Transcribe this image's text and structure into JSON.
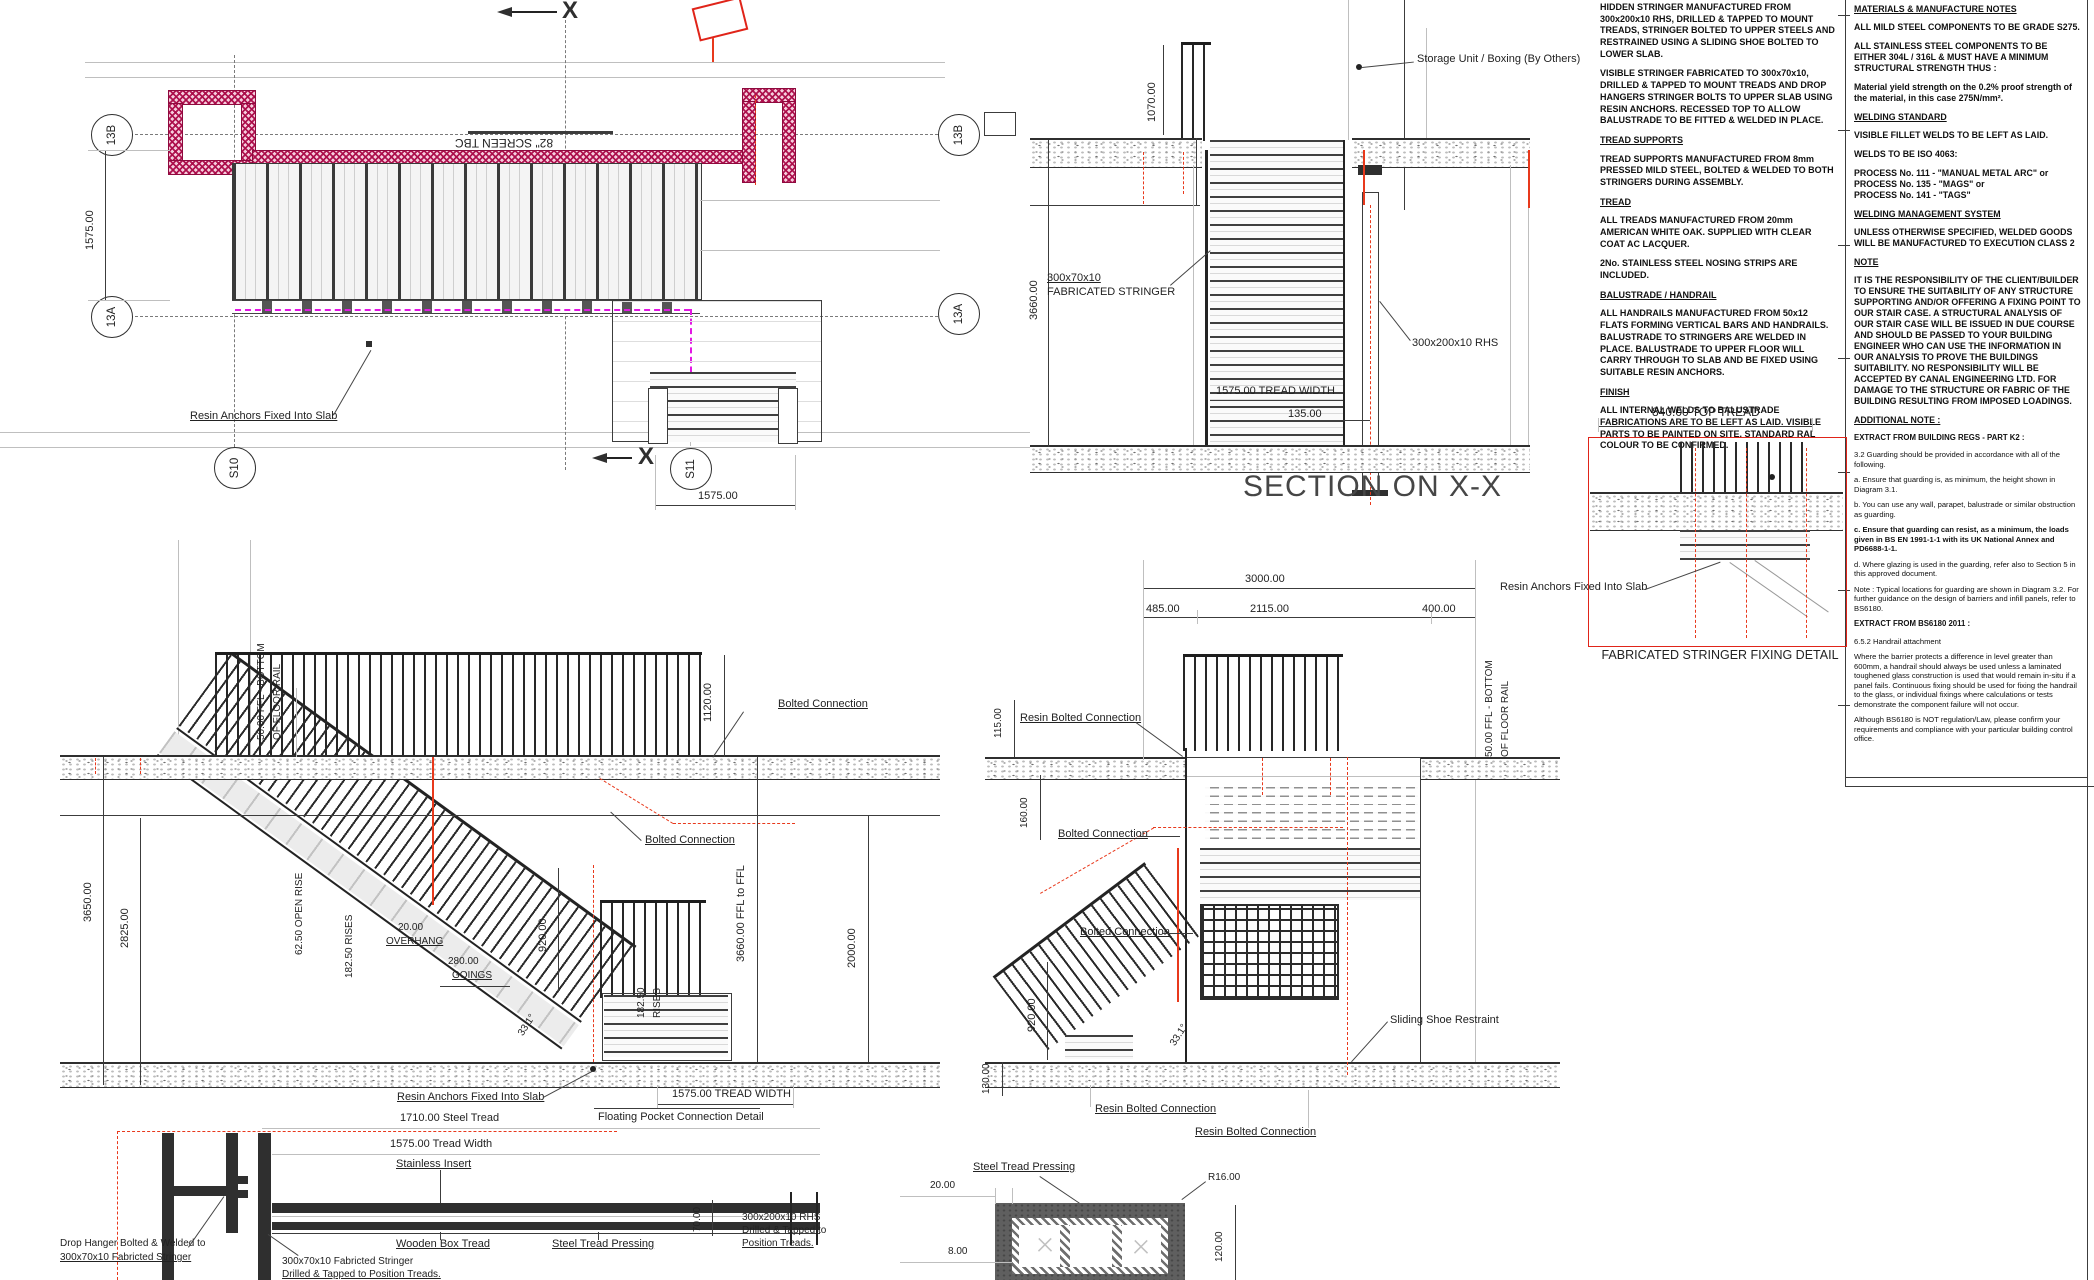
{
  "plan": {
    "screen_label": "82\" SCREEN TBC",
    "resin_anchors": "Resin Anchors Fixed Into Slab",
    "dim_width_v": "1575.00",
    "dim_width_h": "1575.00",
    "section_marker": "X",
    "bubbles": {
      "b13b": "13B",
      "b13a": "13A",
      "s10": "S10",
      "s11": "S11"
    }
  },
  "section_xx": {
    "title": "SECTION ON X-X",
    "storage_label": "Storage Unit / Boxing (By Others)",
    "dim_1070": "1070.00",
    "dim_3660": "3660.00",
    "stringer_label_1": "300x70x10",
    "stringer_label_2": "FABRICATED STRINGER",
    "rhs_label": "300x200x10 RHS",
    "dim_tread_width": "1575.00 TREAD WIDTH",
    "dim_135": "135.00"
  },
  "fabrication_notes": {
    "p_hidden": "HIDDEN STRINGER MANUFACTURED FROM 300x200x10 RHS, DRILLED & TAPPED TO MOUNT TREADS, STRINGER BOLTED TO UPPER STEELS AND RESTRAINED USING A SLIDING SHOE BOLTED TO LOWER SLAB.",
    "p_visible": "VISIBLE STRINGER FABRICATED TO 300x70x10, DRILLED & TAPPED TO MOUNT TREADS AND DROP HANGERS STRINGER BOLTS TO UPPER SLAB USING RESIN ANCHORS. RECESSED TOP TO ALLOW BALUSTRADE TO BE FITTED & WELDED IN PLACE.",
    "h_tread_supports": "TREAD SUPPORTS",
    "p_tread_supports": "TREAD SUPPORTS MANUFACTURED FROM 8mm PRESSED MILD STEEL, BOLTED & WELDED TO BOTH STRINGERS DURING ASSEMBLY.",
    "h_tread": "TREAD",
    "p_tread_1": "ALL TREADS MANUFACTURED FROM 20mm AMERICAN WHITE OAK. SUPPLIED WITH CLEAR COAT AC LACQUER.",
    "p_tread_2": "2No. STAINLESS STEEL NOSING STRIPS ARE INCLUDED.",
    "h_balustrade": "BALUSTRADE / HANDRAIL",
    "p_balustrade": "ALL HANDRAILS MANUFACTURED FROM 50x12 FLATS FORMING VERTICAL BARS AND HANDRAILS. BALUSTRADE TO STRINGERS ARE WELDED IN PLACE. BALUSTRADE TO UPPER FLOOR WILL CARRY THROUGH TO SLAB AND BE FIXED USING SUITABLE RESIN ANCHORS.",
    "h_finish": "FINISH",
    "p_finish": "ALL INTERNAL WELDS TO BALUSTRADE FABRICATIONS ARE TO BE LEFT AS LAID. VISIBLE PARTS TO BE PAINTED ON SITE. STANDARD RAL COLOUR TO BE CONFIRMED."
  },
  "fixing_detail": {
    "dim_840": "840.00 TOP TREAD",
    "resin_anchors": "Resin Anchors Fixed Into Slab",
    "title": "FABRICATED STRINGER FIXING DETAIL"
  },
  "materials_notes": {
    "h_main": "MATERIALS & MANUFACTURE NOTES",
    "p1": "ALL MILD STEEL COMPONENTS TO BE GRADE S275.",
    "p2": "ALL STAINLESS STEEL COMPONENTS TO BE EITHER 304L / 316L & MUST HAVE A MINIMUM STRUCTURAL STRENGTH THUS :",
    "p3": "Material yield strength on the 0.2% proof strength of the material, in this case 275N/mm².",
    "h_welding": "WELDING STANDARD",
    "p4": "VISIBLE FILLET WELDS TO BE LEFT AS LAID.",
    "p5": "WELDS TO BE ISO 4063:",
    "p6a": "PROCESS No. 111 - \"MANUAL METAL ARC\" or",
    "p6b": "PROCESS No. 135 - \"MAGS\" or",
    "p6c": "PROCESS No. 141 - \"TAGS\"",
    "h_wms": "WELDING MANAGEMENT SYSTEM",
    "p7": "UNLESS OTHERWISE SPECIFIED, WELDED GOODS WILL BE MANUFACTURED TO EXECUTION CLASS 2",
    "h_note": "NOTE",
    "p8": "IT IS THE RESPONSIBILITY OF THE CLIENT/BUILDER TO ENSURE THE SUITABILITY OF ANY STRUCTURE SUPPORTING AND/OR OFFERING A FIXING POINT TO OUR STAIR CASE. A STRUCTURAL ANALYSIS OF OUR STAIR CASE WILL BE ISSUED IN DUE COURSE AND SHOULD BE PASSED TO YOUR BUILDING ENGINEER WHO CAN USE THE INFORMATION IN OUR ANALYSIS TO PROVE THE BUILDINGS SUITABILITY. NO RESPONSIBILITY WILL BE ACCEPTED BY CANAL ENGINEERING LTD. FOR DAMAGE TO THE STRUCTURE OR FABRIC OF THE BUILDING RESULTING FROM IMPOSED LOADINGS.",
    "h_additional": "ADDITIONAL NOTE :",
    "h_extract_k2": "EXTRACT FROM BUILDING REGS - PART K2 :",
    "k2_intro": "3.2 Guarding should be provided in accordance with all of the following.",
    "k2_a": "a. Ensure that guarding is, as minimum, the height shown in Diagram 3.1.",
    "k2_b": "b. You can use any wall, parapet, balustrade or similar obstruction as guarding.",
    "k2_c": "c. Ensure that guarding can resist, as a minimum, the loads given in BS EN 1991-1-1 with its UK National Annex and PD6688-1-1.",
    "k2_d": "d. Where glazing is used in the guarding, refer also to Section 5 in this approved document.",
    "k2_note": "Note : Typical locations for guarding are shown in Diagram 3.2. For further guidance on the design of barriers and infill panels, refer to BS6180.",
    "h_extract_bs": "EXTRACT FROM BS6180 2011 :",
    "bs_sub": "6.5.2 Handrail attachment",
    "bs_p1": "Where the barrier protects a difference in level greater than 600mm, a handrail should always be used unless a laminated toughened glass construction is used that would remain in-situ if a panel fails. Continuous fixing should be used for fixing the handrail to the glass, or individual fixings where calculations or tests demonstrate the component failure will not occur.",
    "bs_p2": "Although BS6180 is NOT regulation/Law, please confirm your requirements and compliance with your particular building control office."
  },
  "elevation_side": {
    "dim_3650": "3650.00",
    "dim_2825": "2825.00",
    "ffl_note_1": "50.00 FFL - BOTTOM",
    "ffl_note_2": "OF FLOOR RAIL",
    "dim_1120": "1120.00",
    "bolted_connection": "Bolted Connection",
    "open_rise": "62.50 OPEN RISE",
    "rises": "182.50 RISES",
    "overhang_1": "20.00",
    "overhang_2": "OVERHANG",
    "goings_1": "280.00",
    "goings_2": "GOINGS",
    "dim_920": "920.00",
    "angle": "33.1°",
    "dim_2000": "2000.00",
    "rises2_1": "182.50",
    "rises2_2": "RISES",
    "resin_anchors": "Resin Anchors Fixed Into Slab",
    "tread_width": "1575.00 TREAD WIDTH",
    "floating_pocket": "Floating Pocket Connection Detail"
  },
  "elevation_front": {
    "dim_3000": "3000.00",
    "dim_485": "485.00",
    "dim_2115": "2115.00",
    "dim_400": "400.00",
    "dim_115": "115.00",
    "dim_160": "160.00",
    "dim_130": "130.00",
    "dim_920": "920.00",
    "dim_ffl": "3660.00 FFL to FFL",
    "angle": "33.1°",
    "resin_bolted": "Resin Bolted Connection",
    "bolted": "Bolted Connection",
    "sliding_shoe": "Sliding Shoe Restraint",
    "resin_bolted_b1": "Resin Bolted Connection",
    "resin_bolted_b2": "Resin Bolted Connection",
    "ffl_note_1": "50.00 FFL - BOTTOM",
    "ffl_note_2": "OF FLOOR RAIL"
  },
  "tread_detail": {
    "dim_1710": "1710.00 Steel Tread",
    "dim_1575": "1575.00 Tread Width",
    "stainless": "Stainless Insert",
    "wooden": "Wooden Box Tread",
    "pressing": "Steel Tread Pressing",
    "drop_hanger_1": "Drop Hanger Bolted & Welded to",
    "drop_hanger_2": "300x70x10 Fabricted Stringer",
    "stringer_1": "300x70x10 Fabricted Stringer",
    "stringer_2": "Drilled & Tapped to Position Treads.",
    "rhs_1": "300x200x10 RHS",
    "rhs_2": "Drilled & Tapped to",
    "rhs_3": "Position Treads.",
    "dim_70": "70.00"
  },
  "pressing_detail": {
    "label": "Steel Tread Pressing",
    "dim_20": "20.00",
    "dim_8": "8.00",
    "r16": "R16.00",
    "dim_120": "120.00"
  }
}
